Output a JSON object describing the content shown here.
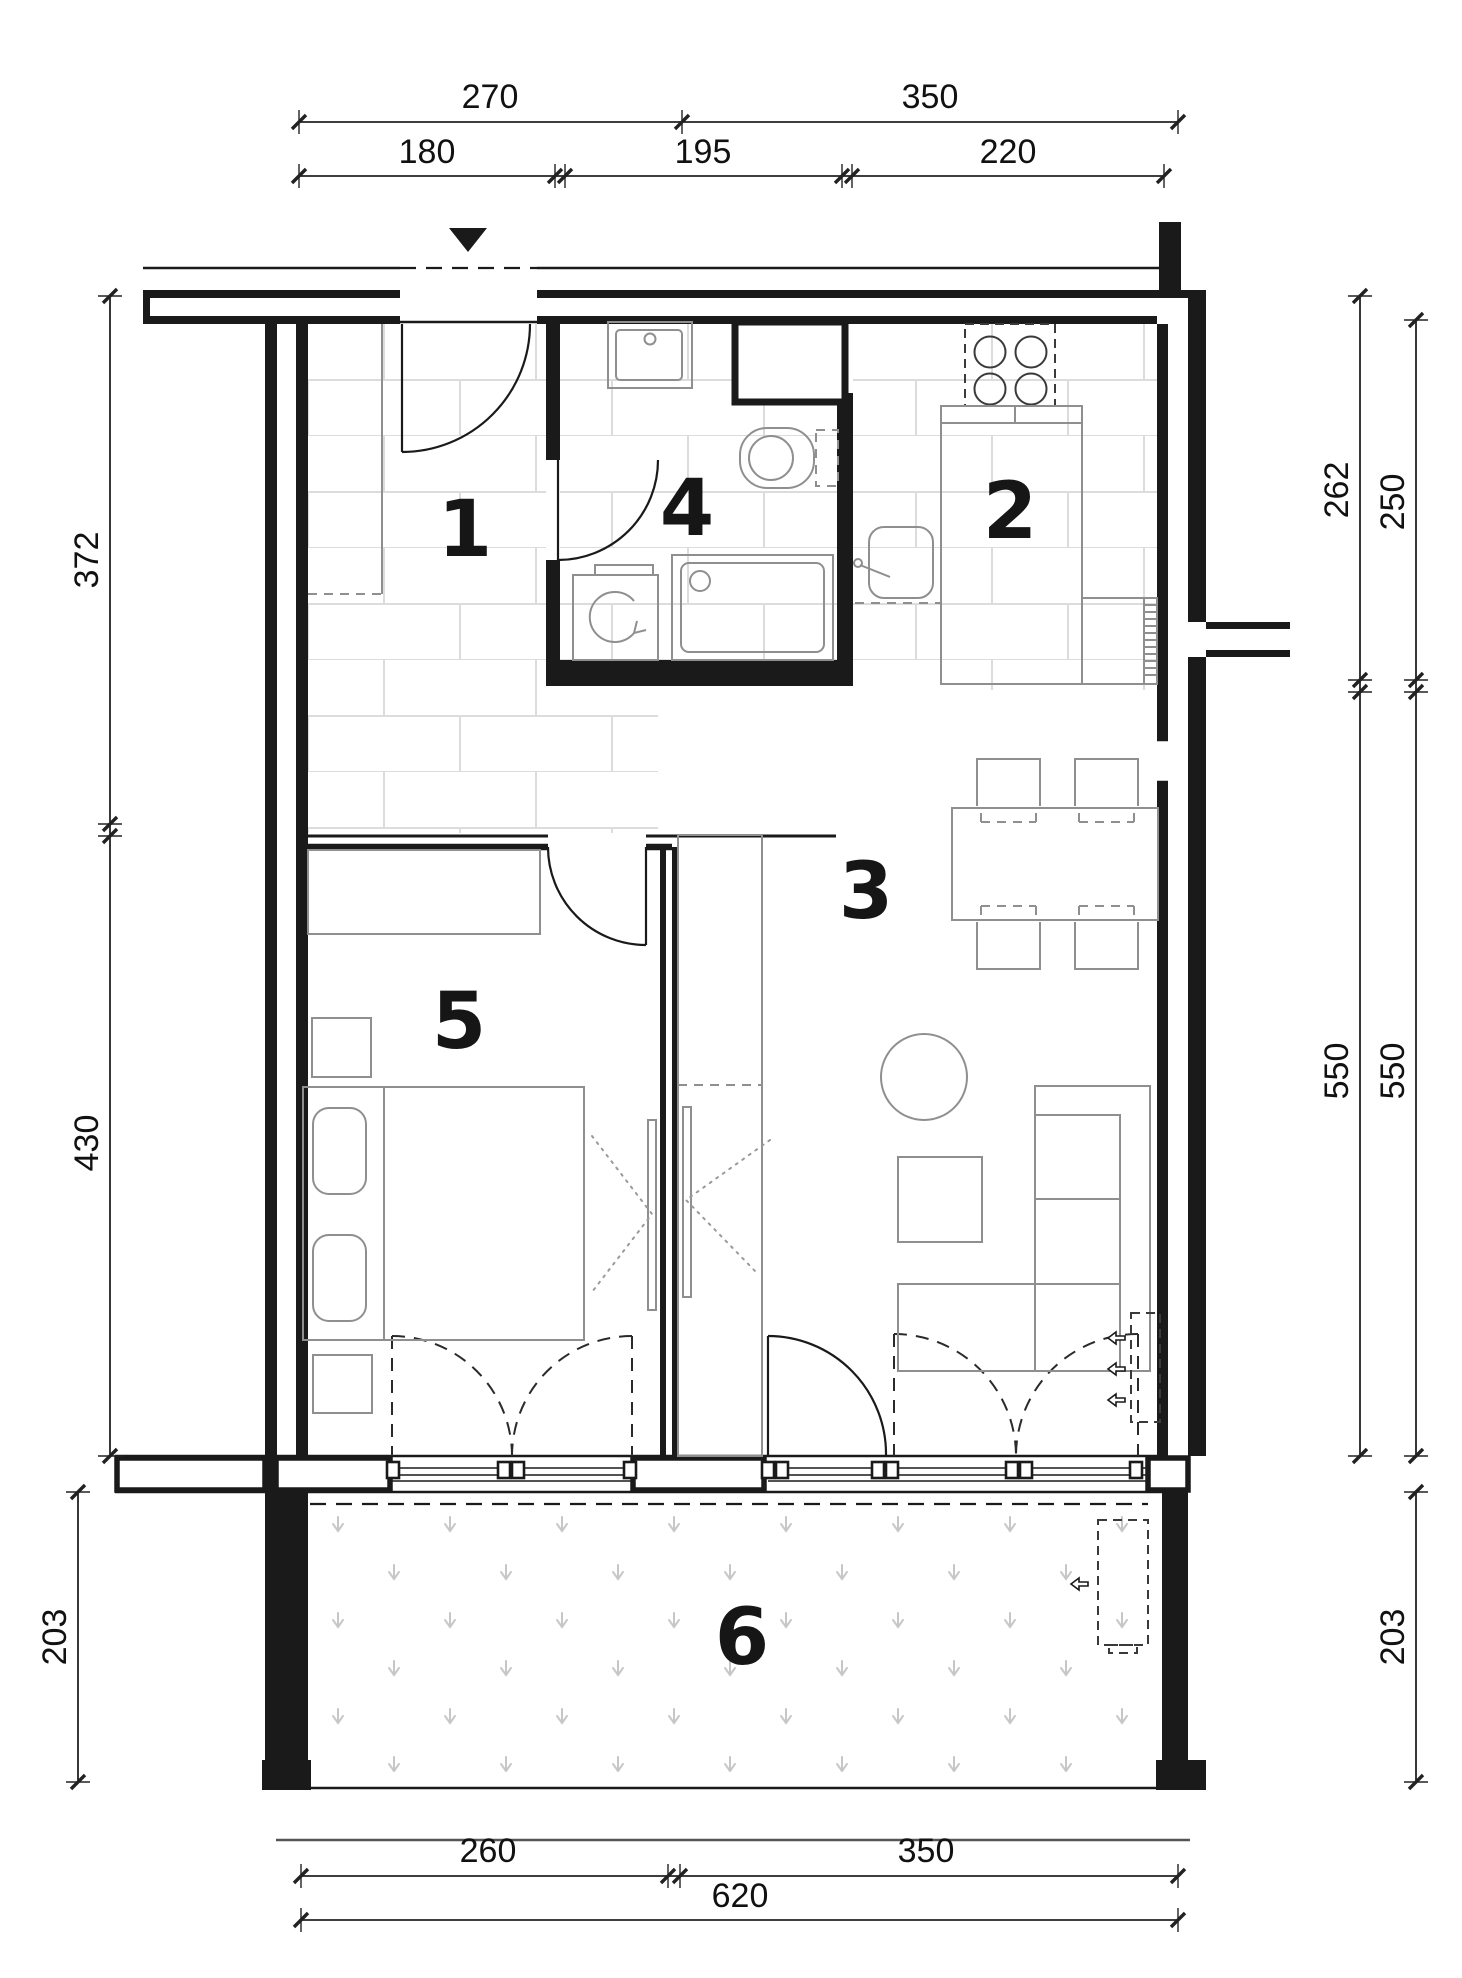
{
  "drawing": {
    "kind": "apartment floor plan"
  },
  "rooms": [
    "1",
    "2",
    "3",
    "4",
    "5",
    "6"
  ],
  "dimensions": {
    "top_primary": [
      "270",
      "350"
    ],
    "top_secondary": [
      "180",
      "195",
      "220"
    ],
    "left_vertical": [
      "372",
      "430"
    ],
    "left_balcony": "203",
    "right_inner": [
      "262",
      "550"
    ],
    "right_outer": [
      "250",
      "550"
    ],
    "right_balcony": "203",
    "bottom_segments": [
      "260",
      "350"
    ],
    "bottom_total": "620"
  },
  "colors": {
    "wall": "#1a1a1a",
    "furniture": "#8f8f8f",
    "tile_joint": "#dcdcdc",
    "balcony_dot": "#c6c6c6",
    "paper": "#ffffff"
  }
}
